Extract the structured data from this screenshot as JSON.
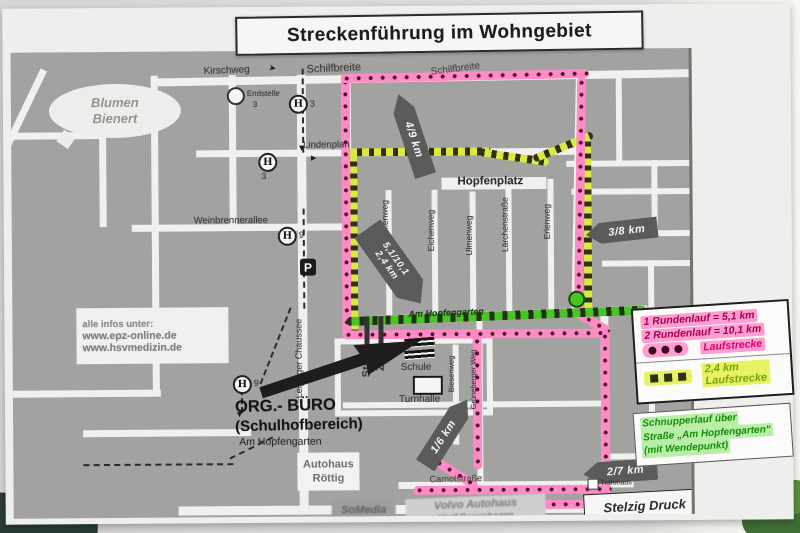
{
  "title": "Streckenführung im Wohngebiet",
  "streets": {
    "kirschweg": "Kirschweg",
    "schilfbreite_w": "Schilfbreite",
    "schilfbreite_e": "Schilfbreite",
    "lindenplan": "Lindenplan",
    "hopfenplatz": "Hopfenplatz",
    "weinbrennerallee": "Weinbrennerallee",
    "leipziger_chaussee": "Leipziger Chaussee",
    "am_hopfengarten": "Am Hopfengarten",
    "birkenweg": "Birkenweg",
    "eichenweg": "Eichenweg",
    "ulmenweg": "Ulmenweg",
    "laerchenstrasse": "Lärchenstraße",
    "erlenweg": "Erlenweg",
    "biesenweg": "Biesenweg",
    "grueneberger_weg": "Grüneberger Weg",
    "carnotstrasse": "Carnotstraße"
  },
  "transit": {
    "stop_symbol": "H",
    "endstelle_label": "Endstelle",
    "endstelle_line": "3",
    "stop1_line": "3",
    "stop2_line": "3",
    "stop3_line": "9",
    "stop4_line": "9",
    "parking": "P"
  },
  "places": {
    "blumen_1": "Blumen",
    "blumen_2": "Bienert",
    "schule": "Schule",
    "turnhalle": "Turnhalle",
    "start": "Start",
    "ziel": "Ziel",
    "org_line1": "ORG.- BÜRO",
    "org_line2": "(Schulhofbereich)",
    "org_line3": "Am Hopfengarten",
    "autohaus_1": "Autohaus",
    "autohaus_2": "Röttig",
    "somedia": "SoMedia",
    "volvo_1": "Volvo Autohaus",
    "volvo_2": "Wolf Degenhagen",
    "stelzig": "Stelzig Druck",
    "trafohaus": "Trafohaus"
  },
  "info_box": {
    "line1": "alle infos unter:",
    "line2": "www.epz-online.de",
    "line3": "www.hsvmedizin.de"
  },
  "km_markers": {
    "k49": "4/9 km",
    "k38": "3/8 km",
    "k16": "1/6 km",
    "k27": "2/7 km",
    "finish_1": "5,1/10,1",
    "finish_2": "2,4 km"
  },
  "legend": {
    "round1": "1 Rundenlauf = 5,1 km",
    "round2": "2 Rundenlauf = 10,1 km",
    "pink_route_label": "Laufstrecke",
    "yellow_km": "2,4 km",
    "yellow_route_label": "Laufstrecke",
    "green_1": "Schnupperlauf über",
    "green_2": "Straße „Am Hopfengarten“",
    "green_3": "(mit Wendepunkt)"
  },
  "colors": {
    "route_pink": "#ff8ac4",
    "route_dot": "#4f0e2f",
    "route_yellow": "#dbe93f",
    "route_square": "#2e301a",
    "route_green": "#49c427",
    "marker_gray": "#5b5b59",
    "legend_pink_text": "#a6004f",
    "legend_green_text": "#178c05"
  }
}
